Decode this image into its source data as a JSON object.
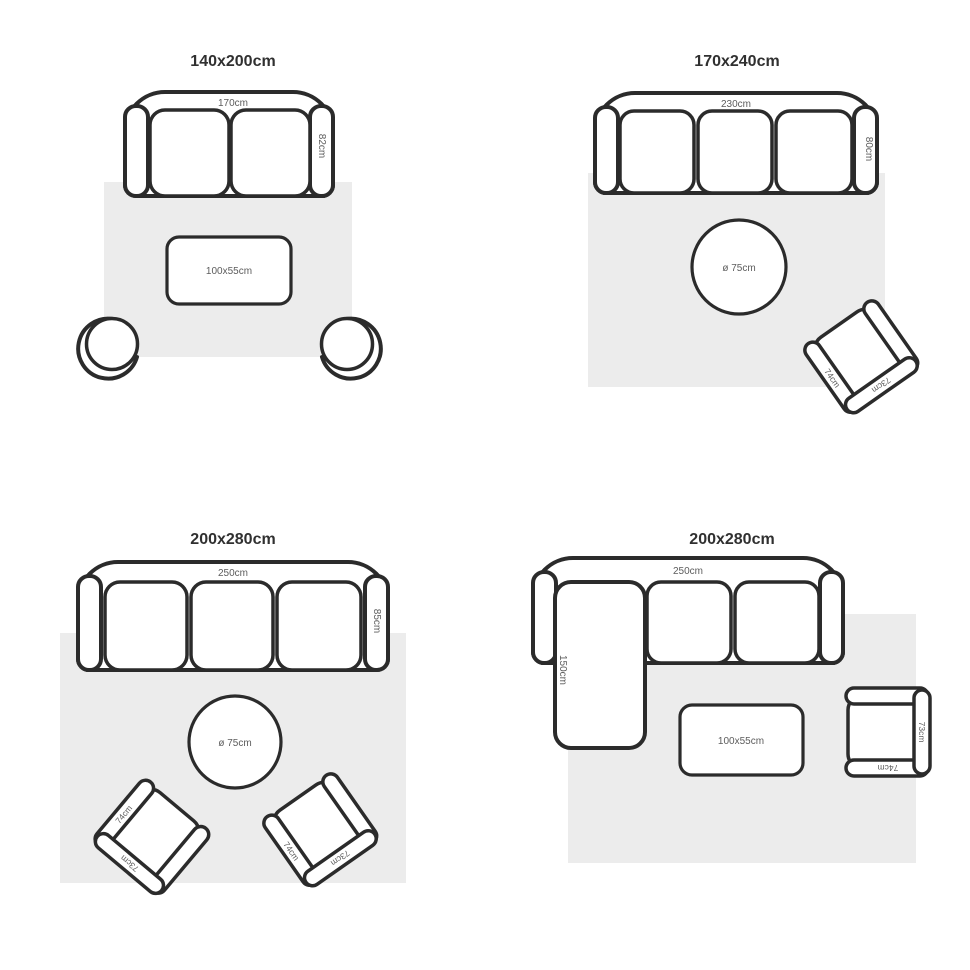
{
  "page": {
    "background": "#ffffff",
    "line_color": "#2b2b2b",
    "rug_fill": "#ececec",
    "label_color": "#5c5c5c",
    "title_color": "#303030"
  },
  "quadrants": [
    {
      "id": "top-left",
      "title": "140x200cm",
      "sofa": {
        "type": "2-seat sofa",
        "width_label": "170cm",
        "depth_label": "82cm"
      },
      "coffee_table": {
        "label": "100x55cm"
      },
      "tub_chairs": 2
    },
    {
      "id": "top-right",
      "title": "170x240cm",
      "sofa": {
        "type": "3-seat sofa",
        "width_label": "230cm",
        "depth_label": "80cm"
      },
      "round_table": {
        "label": "ø 75cm"
      },
      "armchairs": [
        {
          "width_label": "74cm",
          "depth_label": "73cm"
        }
      ]
    },
    {
      "id": "bottom-left",
      "title": "200x280cm",
      "sofa": {
        "type": "3-seat sofa",
        "width_label": "250cm",
        "depth_label": "85cm"
      },
      "round_table": {
        "label": "ø 75cm"
      },
      "armchairs": [
        {
          "width_label": "74cm",
          "depth_label": "73cm"
        },
        {
          "width_label": "74cm",
          "depth_label": "73cm"
        }
      ]
    },
    {
      "id": "bottom-right",
      "title": "200x280cm",
      "sofa": {
        "type": "corner sofa with chaise",
        "width_label": "250cm",
        "chaise_depth_label": "150cm"
      },
      "coffee_table": {
        "label": "100x55cm"
      },
      "armchairs": [
        {
          "width_label": "74cm",
          "depth_label": "73cm"
        }
      ]
    }
  ]
}
